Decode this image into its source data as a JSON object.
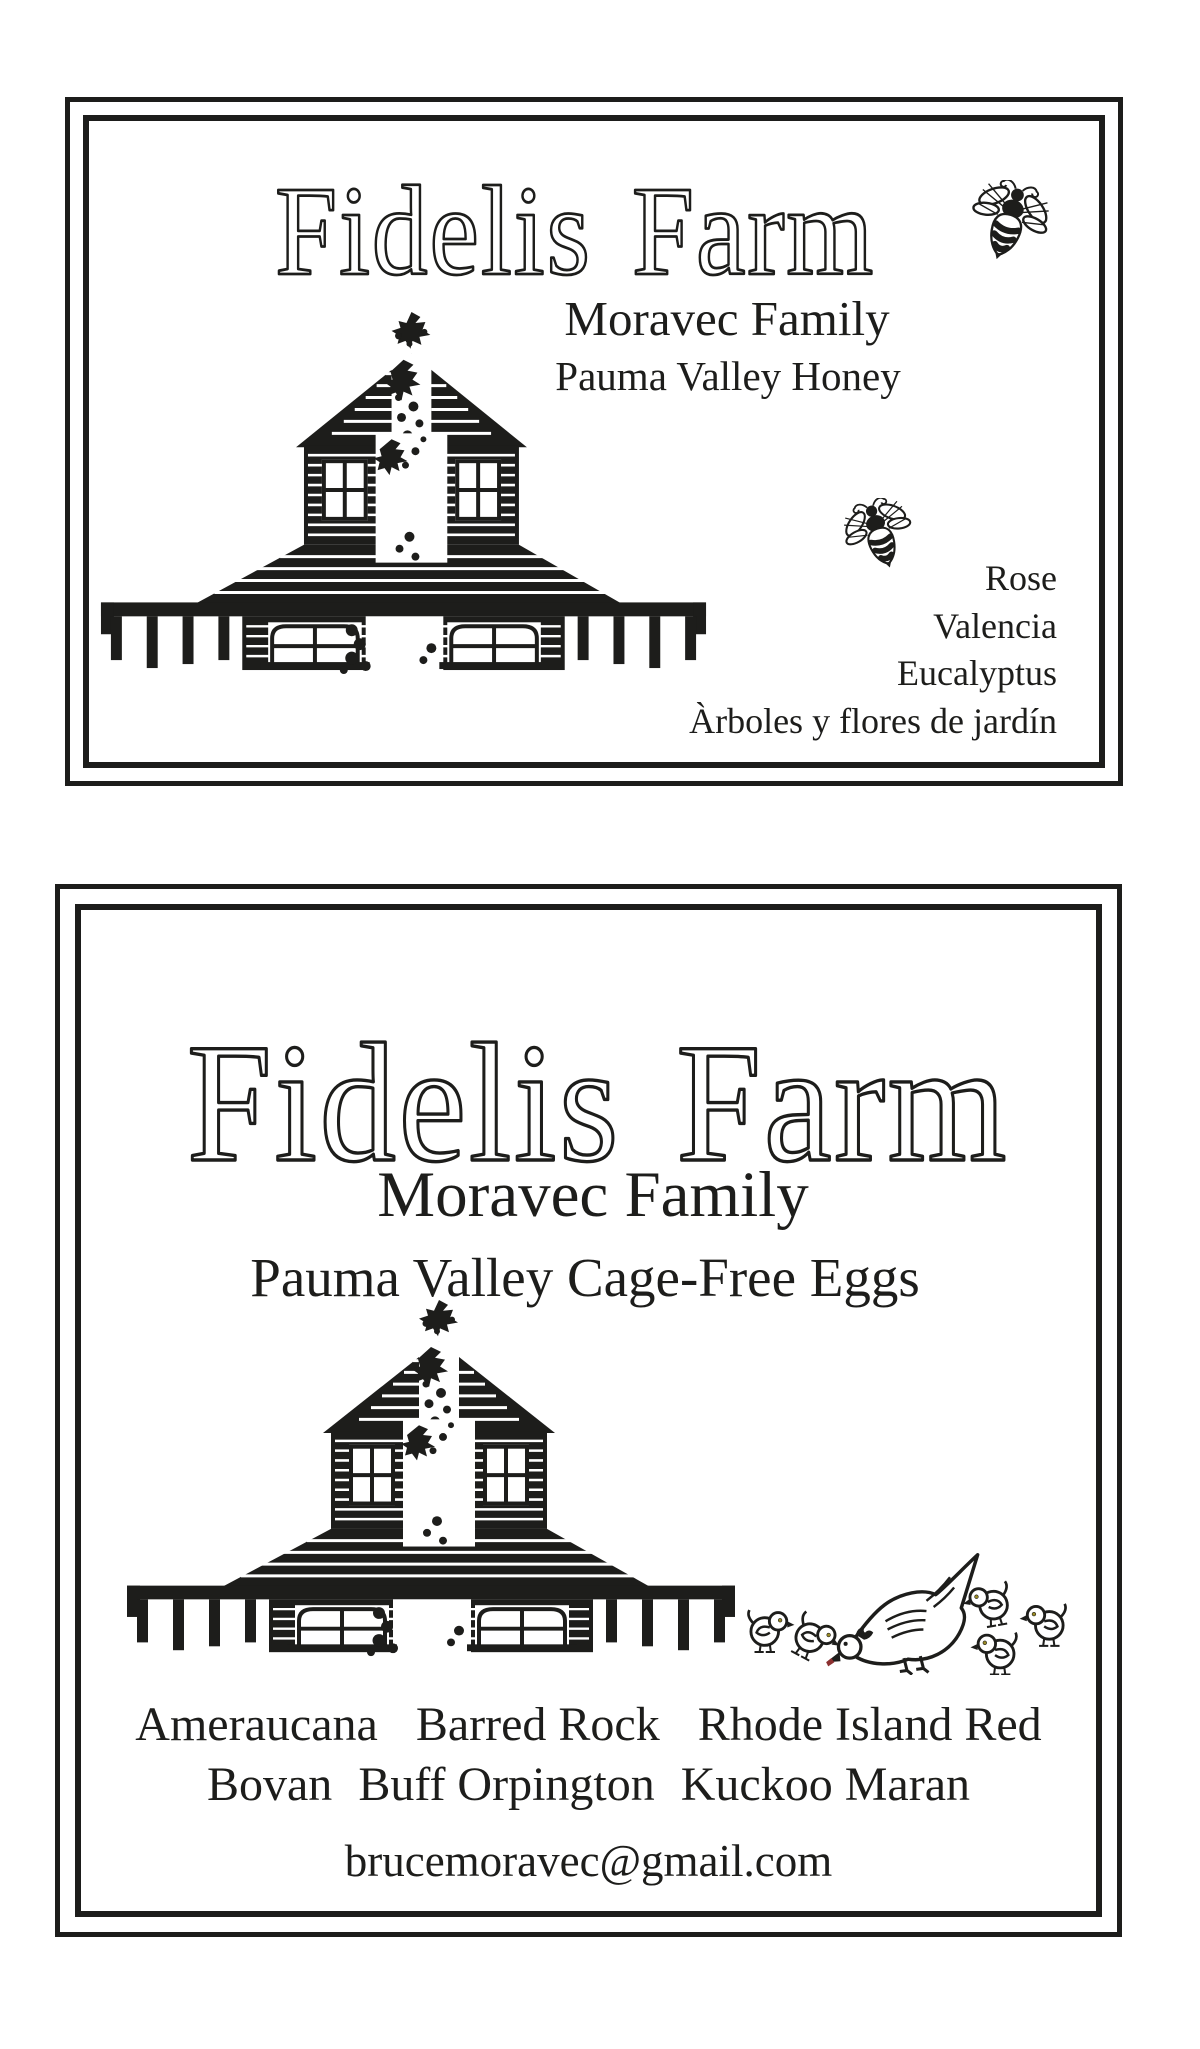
{
  "colors": {
    "ink": "#1d1d1b",
    "paper": "#ffffff",
    "chick_eye": "#9b8b24",
    "hen_beak_tip": "#8c3030"
  },
  "icons": {
    "bee": "bee-icon",
    "barn": "barn-icon",
    "hen_and_chicks": "hen-and-chicks-icon",
    "foliage": "leaf-sprig-icon"
  },
  "honey_label": {
    "title": "Fidelis Farm",
    "family": "Moravec Family",
    "product": "Pauma Valley Honey",
    "varieties": [
      "Rose",
      "Valencia",
      "Eucalyptus",
      "Àrboles y flores de jardín"
    ]
  },
  "egg_label": {
    "title": "Fidelis Farm",
    "family": "Moravec Family",
    "product": "Pauma Valley Cage-Free Eggs",
    "breeds_row1": [
      "Ameraucana",
      "Barred Rock",
      "Rhode Island Red"
    ],
    "breeds_row2": [
      "Bovan",
      "Buff Orpington",
      "Kuckoo Maran"
    ],
    "email": "brucemoravec@gmail.com"
  }
}
